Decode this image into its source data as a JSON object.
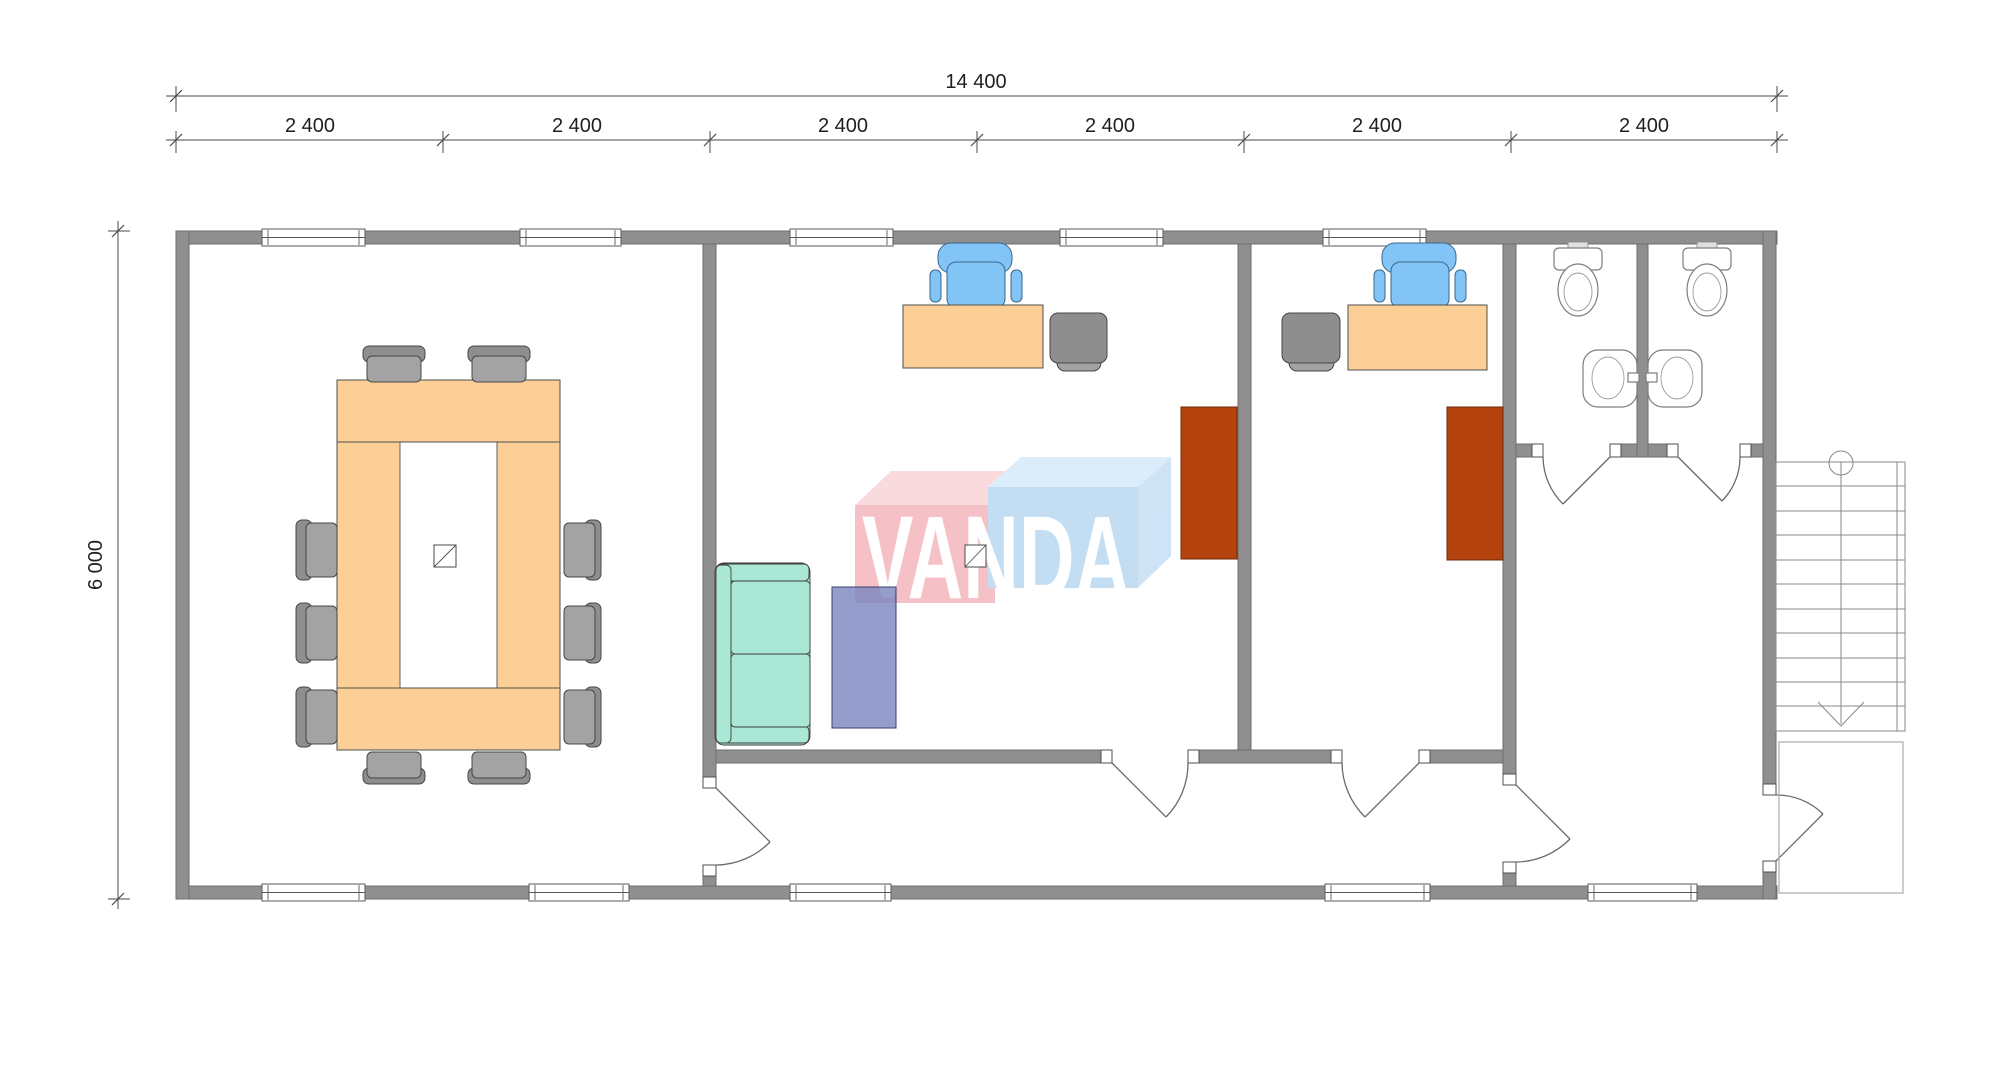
{
  "dimensions": {
    "total_width_label": "14 400",
    "bay_labels": [
      "2 400",
      "2 400",
      "2 400",
      "2 400",
      "2 400",
      "2 400"
    ],
    "height_label": "6 000"
  },
  "logo": {
    "text": "VANDA"
  },
  "colors": {
    "wall": "#8f8f8f",
    "desk": "#fbcf95",
    "cabinet": "#b5430e",
    "sofa": "#abe7d5",
    "bench": "#7b84c0",
    "chair_blue": "#82c4f5",
    "chair_gray": "#8e8e8e",
    "chair_gray_light": "#a3a3a3",
    "logo_pink": "#f5bcc3",
    "logo_pink_top": "#fad8db",
    "logo_blue": "#bedcf2",
    "logo_blue_top": "#d8ebfa",
    "logo_blue_side": "#cae2f5",
    "dim_line": "#4a4a4a",
    "dim_text": "#1f1f1f"
  },
  "rooms": {
    "meeting_room": [
      "conference-table",
      "conference-chair x10",
      "floor-symbol"
    ],
    "office_1": [
      "desk",
      "office-chair",
      "visitor-chair",
      "cabinet",
      "sofa",
      "bench",
      "floor-symbol"
    ],
    "office_2": [
      "desk",
      "office-chair",
      "visitor-chair",
      "cabinet"
    ],
    "wc_left": [
      "toilet",
      "sink"
    ],
    "wc_right": [
      "toilet",
      "sink"
    ],
    "exterior": [
      "staircase",
      "landing"
    ]
  }
}
